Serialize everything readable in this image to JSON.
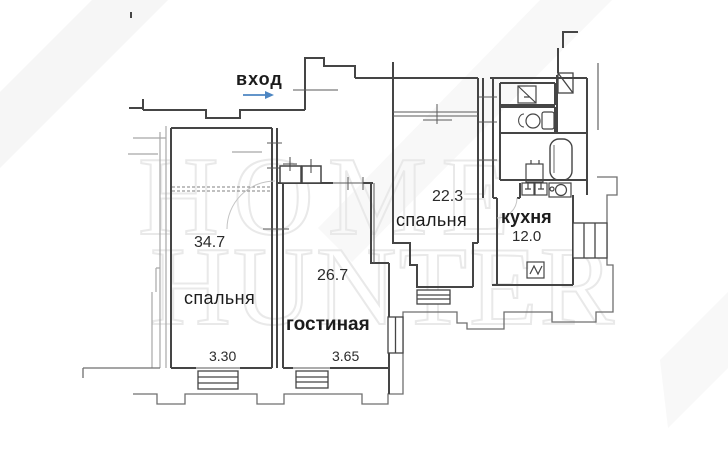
{
  "document": {
    "type": "apartment-floor-plan"
  },
  "watermark": {
    "line1": "HOME",
    "line2": "HUNTER"
  },
  "entrance": {
    "label": "вход"
  },
  "rooms": [
    {
      "id": "bedroom-1",
      "name": "спальня",
      "area": "34.7",
      "ceiling_height": "3.30"
    },
    {
      "id": "living-room",
      "name": "гостиная",
      "area": "26.7",
      "ceiling_height": "3.65"
    },
    {
      "id": "bedroom-2",
      "name": "спальня",
      "area": "22.3"
    },
    {
      "id": "kitchen",
      "name": "кухня",
      "area": "12.0"
    }
  ],
  "colors": {
    "wall": "#454545",
    "arrow": "#4d86c2",
    "watermark": "#e8e8e8",
    "background": "#ffffff"
  }
}
